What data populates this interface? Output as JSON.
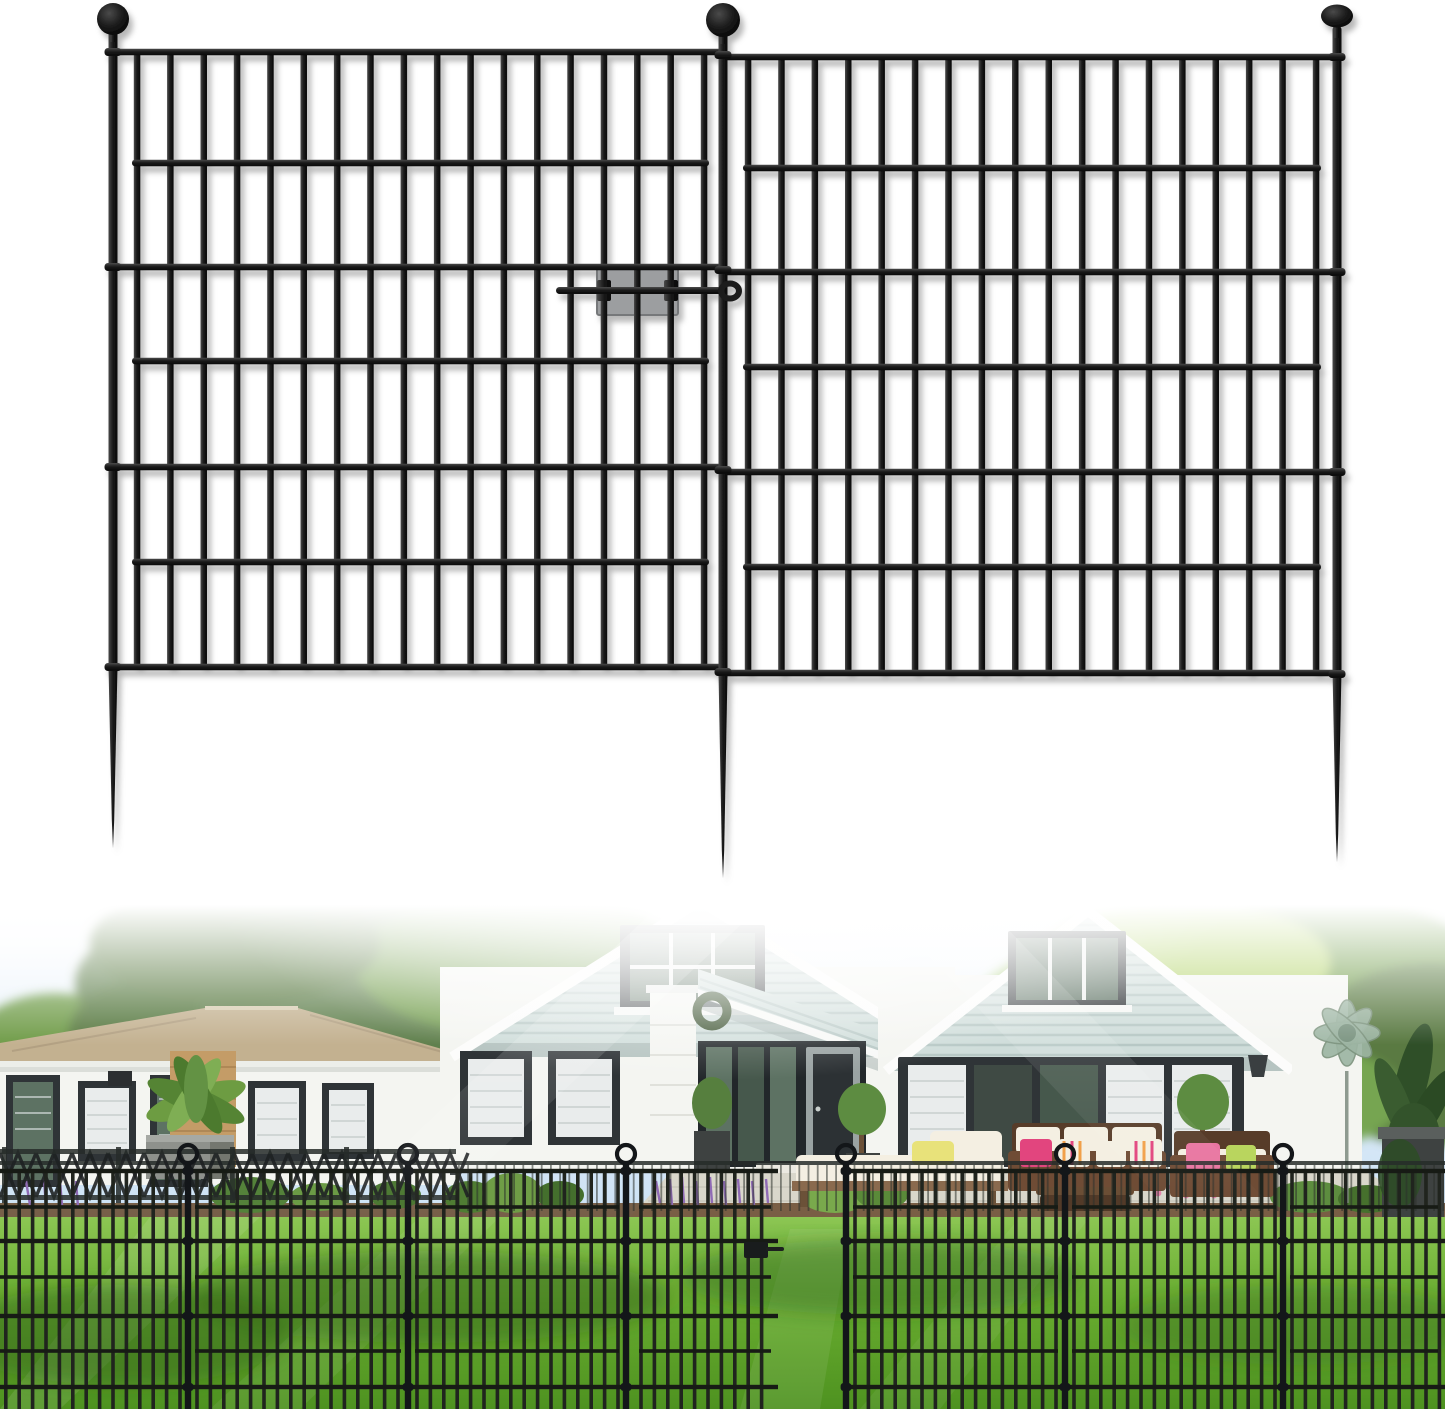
{
  "meta": {
    "image_kind": "e-commerce product image, no text",
    "width": 1445,
    "height": 1409,
    "sections": [
      "product-render",
      "lifestyle-photo"
    ]
  },
  "colors": {
    "metal-hi": "#4a4a4a",
    "metal-mid": "#1c1c1c",
    "metal-dark": "#060606",
    "latch": "#9c9ea0",
    "latch-edge": "#76787a",
    "wall": "#f4f5f1",
    "siding": "#cfddda",
    "siding-line": "#b7c8c5",
    "frame": "#2f3437",
    "glass": "#5d7263",
    "blind": "#e9ecec",
    "roof": "#c3b190",
    "brick": "#c49c67",
    "paver": "#d9d7cb",
    "wood": "#8a6a4e",
    "rattan": "#6f4c35",
    "rattan-dark": "#573c29",
    "cushion": "#f4efe2",
    "pink": "#e2457e",
    "lime": "#b9d55e",
    "yellow": "#e8e27a",
    "planter": "#3e4241",
    "mulch": "#6e5136",
    "sage": "#9db5a3",
    "tree-dark": "#5a7a43",
    "tree-mid": "#6f9c49",
    "tree-bright": "#9ac45f",
    "tree-lime": "#b4d46c",
    "lawn-hi": "#8cc653",
    "lawn-mid": "#68ac2f",
    "lawn-lo": "#4e9220",
    "lawn-shadow": "#2a5c17",
    "fence-photo": "#20241e",
    "fence-photo-dk": "#171b15",
    "fence-photo-post": "#131619",
    "sky-top": "#ffffff",
    "sky-mid": "#dbeaf8",
    "sky-low": "#b9d7ef"
  },
  "product_render": {
    "label": "Two black metal no-dig garden fence panels with ball-finial stake posts and a sliding latch connector on a white background",
    "background": "#ffffff",
    "panel_count": 2,
    "post_count": 3,
    "bars_per_panel": 18,
    "rails_per_panel": 7,
    "bar_w": 6.5,
    "rail_h": 6.5,
    "post_w": 9,
    "posts": [
      {
        "name": "left",
        "x": 113,
        "ball_cy": 19,
        "ball_r": 16,
        "top": 36,
        "bottom": 672,
        "spike_tip": 848,
        "collars": [
          52,
          267,
          467,
          667
        ]
      },
      {
        "name": "center",
        "x": 723,
        "ball_cy": 20,
        "ball_r": 17,
        "top": 38,
        "bottom": 678,
        "spike_tip": 878,
        "collars": [
          55,
          270,
          470,
          672
        ]
      },
      {
        "name": "right",
        "x": 1337,
        "ball_cy": 16,
        "ball_r": 16,
        "ball_ry": 11.5,
        "top": 32,
        "bottom": 676,
        "spike_tip": 862,
        "collars": [
          57,
          272,
          472,
          674
        ]
      }
    ],
    "panels": [
      {
        "name": "left",
        "x0": 137,
        "x1": 704,
        "bar_n": 18,
        "top": 52,
        "bottom": 667,
        "rail_x0": 113,
        "rail_x1": 723,
        "full_rails": [
          52,
          267,
          467,
          667
        ],
        "inner_rails": [
          163,
          361,
          562
        ]
      },
      {
        "name": "right",
        "x0": 748,
        "x1": 1316,
        "bar_n": 18,
        "top": 57,
        "bottom": 673,
        "rail_x0": 723,
        "rail_x1": 1337,
        "full_rails": [
          57,
          272,
          472,
          673
        ],
        "inner_rails": [
          168,
          367,
          567
        ]
      }
    ],
    "latch": {
      "plate": {
        "x": 597,
        "y": 268,
        "w": 81,
        "h": 47
      },
      "rod": {
        "x": 556,
        "y": 287,
        "len": 168,
        "h": 7
      },
      "hook": {
        "cx": 730,
        "cy": 291,
        "rx": 9,
        "ry": 7.5
      },
      "clip_xs": [
        597,
        664
      ],
      "clip_y": 280,
      "clip_w": 14,
      "clip_h": 21
    }
  },
  "photo": {
    "label": "Lifestyle photo: black garden fence installed across a green lawn in front of white houses with seafoam gable siding, patio furniture and trees",
    "y": 905,
    "h": 504,
    "fence": {
      "posts_x": [
        188,
        408,
        626,
        846,
        1065,
        1283
      ],
      "ring_cy": 249,
      "ring_r": 9,
      "top": 266,
      "bottom": 504,
      "rails_full": [
        266,
        336,
        411,
        482
      ],
      "rails_inner": [
        302,
        372,
        446
      ],
      "rail_segments": [
        [
          0,
          778
        ],
        [
          846,
          1445
        ]
      ],
      "bar_step": 13.4,
      "bar_w": 3.6,
      "post_w": 6.4,
      "segments": [
        [
          -30,
          188
        ],
        [
          188,
          408
        ],
        [
          408,
          626
        ],
        [
          632,
          778
        ],
        [
          846,
          1065
        ],
        [
          1065,
          1283
        ],
        [
          1283,
          1490
        ]
      ],
      "gate": {
        "x0": 632,
        "x1": 778,
        "latch_x": 744,
        "latch_y": 337
      },
      "opening": [
        778,
        846
      ]
    },
    "backdrop_railing": {
      "x0": 458,
      "x1": 1445,
      "step": 9.2,
      "y0": 260,
      "y1": 306,
      "rail_y": 256
    },
    "lattice_railing": {
      "x0": 0,
      "x1": 456,
      "step": 36,
      "y_top": 248,
      "y_bot": 292
    }
  }
}
